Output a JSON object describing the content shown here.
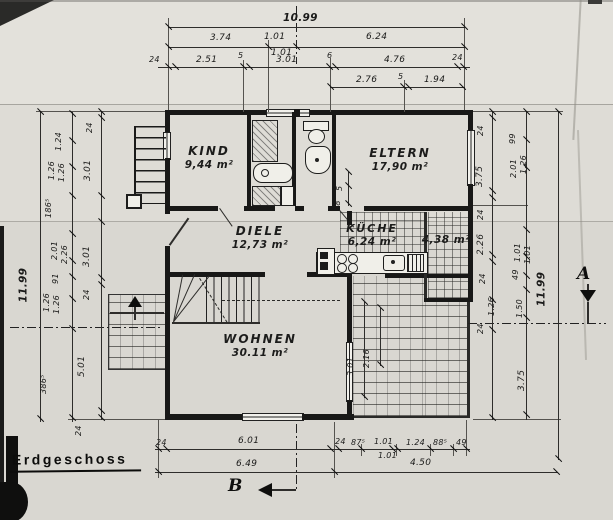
{
  "sheet": {
    "title": "Erdgeschoss"
  },
  "rooms": {
    "kind": {
      "name": "KIND",
      "area": "9,44 m²"
    },
    "eltern": {
      "name": "ELTERN",
      "area": "17,90 m²"
    },
    "diele": {
      "name": "DIELE",
      "area": "12,73 m²"
    },
    "kueche": {
      "name": "KÜCHE",
      "area": "6,24 m²"
    },
    "kammer": {
      "area": "4,38 m²"
    },
    "wohnen": {
      "name": "WOHNEN",
      "area": "30.11 m²"
    }
  },
  "markers": {
    "a": "A",
    "b": "B"
  },
  "dims": {
    "top": {
      "total": "10.99",
      "r2": [
        "3.74",
        "1.01",
        "1.01",
        "6.24"
      ],
      "r3": [
        "24",
        "2.51",
        "5",
        "3.01",
        "6",
        "4.76",
        "24"
      ],
      "r4": [
        "2.76",
        "5",
        "1.94"
      ]
    },
    "bottom": {
      "r1": [
        "24",
        "6.01",
        "24",
        "87⁵",
        "1.01",
        "1.01",
        "1.24",
        "88⁵",
        "49"
      ],
      "r2": [
        "6.49",
        "4.50"
      ]
    },
    "left": {
      "total": "11.99",
      "mid": [
        "1.24",
        "1.26",
        "1.26",
        "186⁵",
        "2.01",
        "2.26",
        "91",
        "1.26",
        "1.26",
        "386⁵"
      ],
      "inner": [
        "24",
        "3.01",
        "3.01",
        "24",
        "5.01",
        "24"
      ]
    },
    "right": {
      "total": "11.99",
      "inner": [
        "24",
        "3.75",
        "24",
        "2.26",
        "24",
        "1.26",
        "24"
      ],
      "mid": [
        "99",
        "2.01",
        "1.26",
        "1.01",
        "1.01",
        "49",
        "1.50",
        "3.75"
      ]
    },
    "terrace": [
      "3.01",
      "2.16"
    ],
    "door": [
      "5",
      "88"
    ]
  }
}
